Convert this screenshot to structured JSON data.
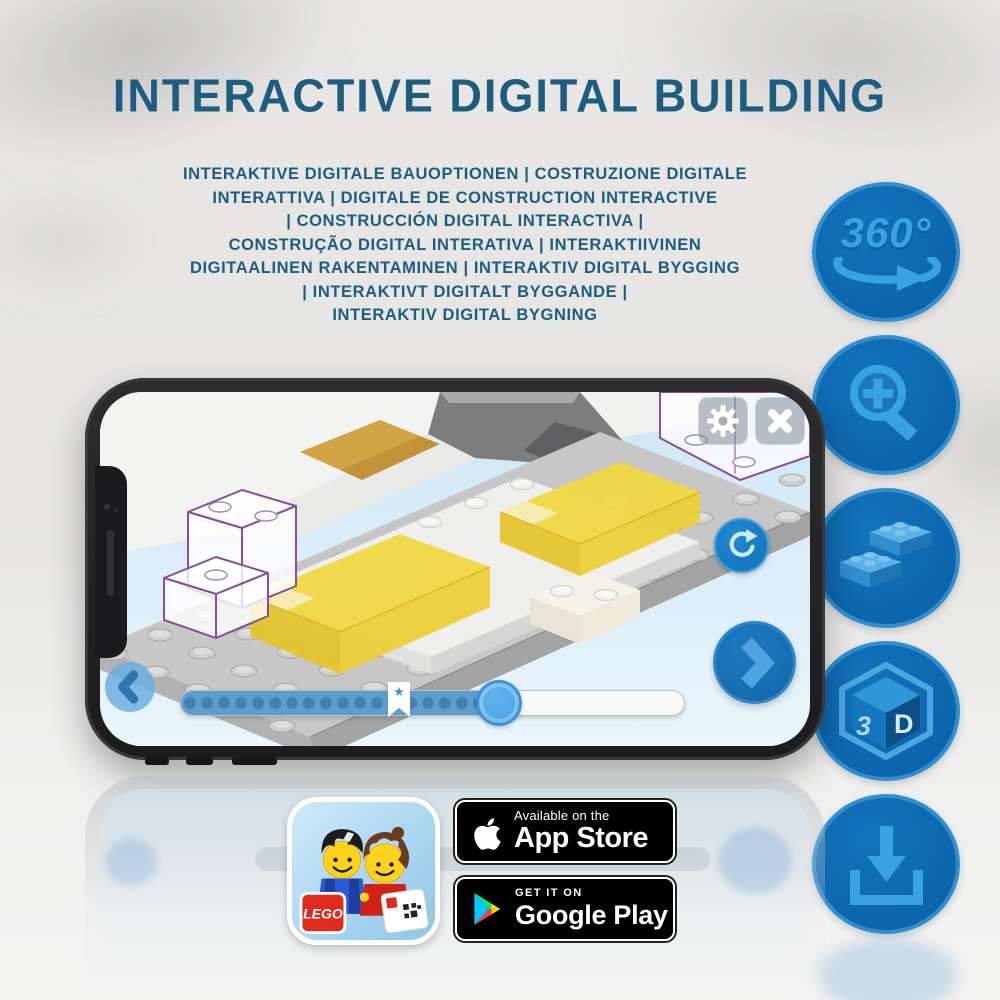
{
  "header": {
    "title": "INTERACTIVE DIGITAL BUILDING"
  },
  "subtitle": {
    "lines": [
      "INTERAKTIVE DIGITALE BAUOPTIONEN | COSTRUZIONE DIGITALE",
      "INTERATTIVA | DIGITALE DE CONSTRUCTION INTERACTIVE",
      "| CONSTRUCCIÓN DIGITAL INTERACTIVA |",
      "CONSTRUÇÃO DIGITAL INTERATIVA | INTERAKTIIVINEN",
      "DIGITAALINEN RAKENTAMINEN | INTERAKTIV DIGITAL BYGGING",
      "| INTERAKTIVT DIGITALT BYGGANDE |",
      "INTERAKTIV DIGITAL BYGNING"
    ]
  },
  "feature_rail": {
    "icons": [
      "rotate-360",
      "zoom-in",
      "lego-bricks",
      "cube-3d",
      "download"
    ],
    "rotate_label": "360°",
    "cube_label_3": "3",
    "cube_label_d": "D"
  },
  "phone_app": {
    "toolbar_icons": [
      "gear-icon",
      "close-icon"
    ],
    "side_icon": "rotate-reset-icon",
    "nav_icons": [
      "back-icon",
      "next-icon"
    ],
    "bookmark_star": "★",
    "progress": {
      "handle_percent": 61,
      "bookmark_percent": 43
    }
  },
  "badges": {
    "lego_logo": "LEGO",
    "app_store": {
      "line1": "Available on the",
      "line2": "App Store"
    },
    "google_play": {
      "line1": "GET IT ON",
      "line2": "Google Play"
    }
  },
  "colors": {
    "headline_blue": "#1d5e80",
    "circle_fill": "#0d6cb5",
    "circle_border": "#2f8fd0",
    "circle_glyph": "#38a2e2",
    "slider_fill": "#5e9ecf",
    "handle_blue": "#4aa8e8",
    "next_button_blue": "#1b76bd",
    "ghost_outline_purple": "#8a4f9b",
    "bed_yellow": "#f2d840",
    "badge_black": "#000000"
  }
}
